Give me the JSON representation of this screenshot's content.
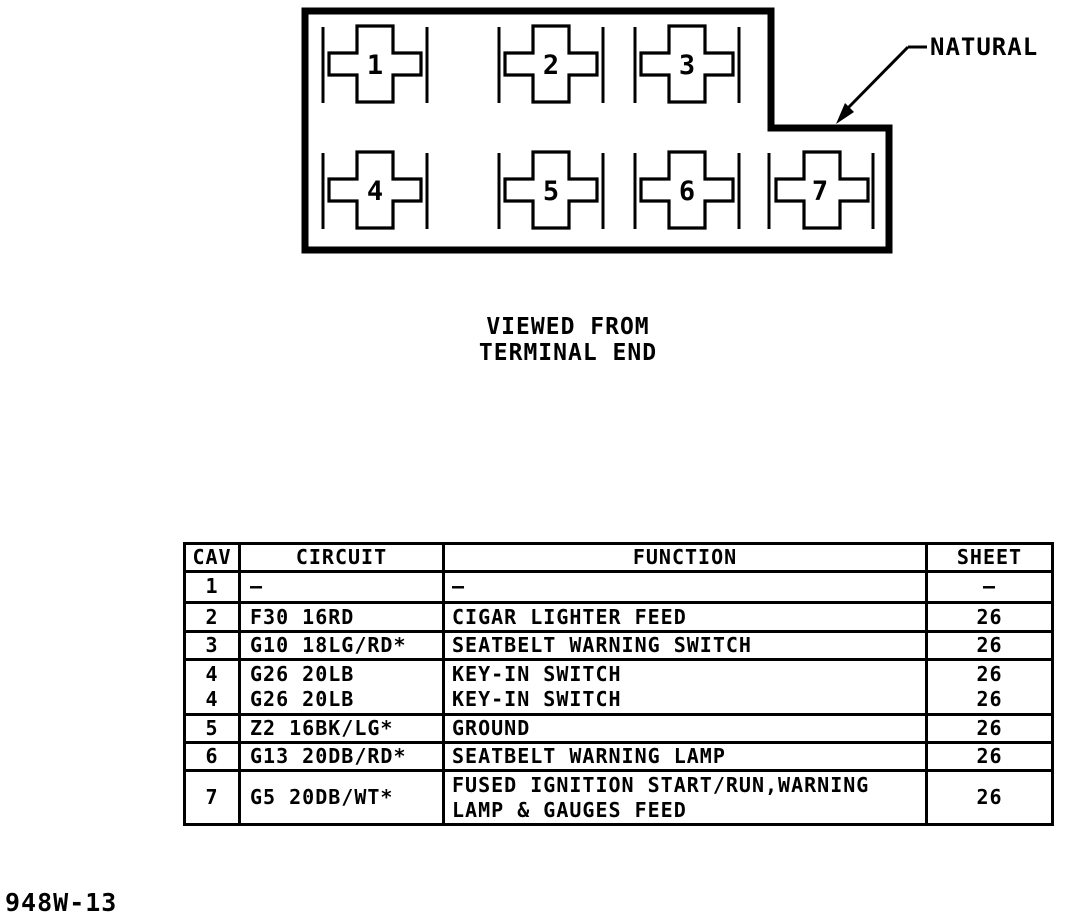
{
  "connector": {
    "material_label": "NATURAL",
    "caption_line1": "VIEWED FROM",
    "caption_line2": "TERMINAL END",
    "cavities": [
      "1",
      "2",
      "3",
      "4",
      "5",
      "6",
      "7"
    ]
  },
  "table": {
    "headers": {
      "cav": "CAV",
      "circuit": "CIRCUIT",
      "function": "FUNCTION",
      "sheet": "SHEET"
    },
    "rows": [
      {
        "cav": "1",
        "circuit": "—",
        "function": "—",
        "sheet": "—"
      },
      {
        "cav": "2",
        "circuit": "F30 16RD",
        "function": "CIGAR LIGHTER FEED",
        "sheet": "26"
      },
      {
        "cav": "3",
        "circuit": "G10 18LG/RD*",
        "function": "SEATBELT WARNING SWITCH",
        "sheet": "26"
      },
      {
        "cav": "4\n4",
        "circuit": "G26 20LB\nG26 20LB",
        "function": "KEY-IN SWITCH\nKEY-IN SWITCH",
        "sheet": "26\n26"
      },
      {
        "cav": "5",
        "circuit": "Z2 16BK/LG*",
        "function": "GROUND",
        "sheet": "26"
      },
      {
        "cav": "6",
        "circuit": "G13 20DB/RD*",
        "function": "SEATBELT WARNING LAMP",
        "sheet": "26"
      },
      {
        "cav": "7",
        "circuit": "G5 20DB/WT*",
        "function": "FUSED IGNITION START/RUN,WARNING\nLAMP & GAUGES FEED",
        "sheet": "26"
      }
    ]
  },
  "footer": {
    "drawing_number": "948W-13"
  }
}
